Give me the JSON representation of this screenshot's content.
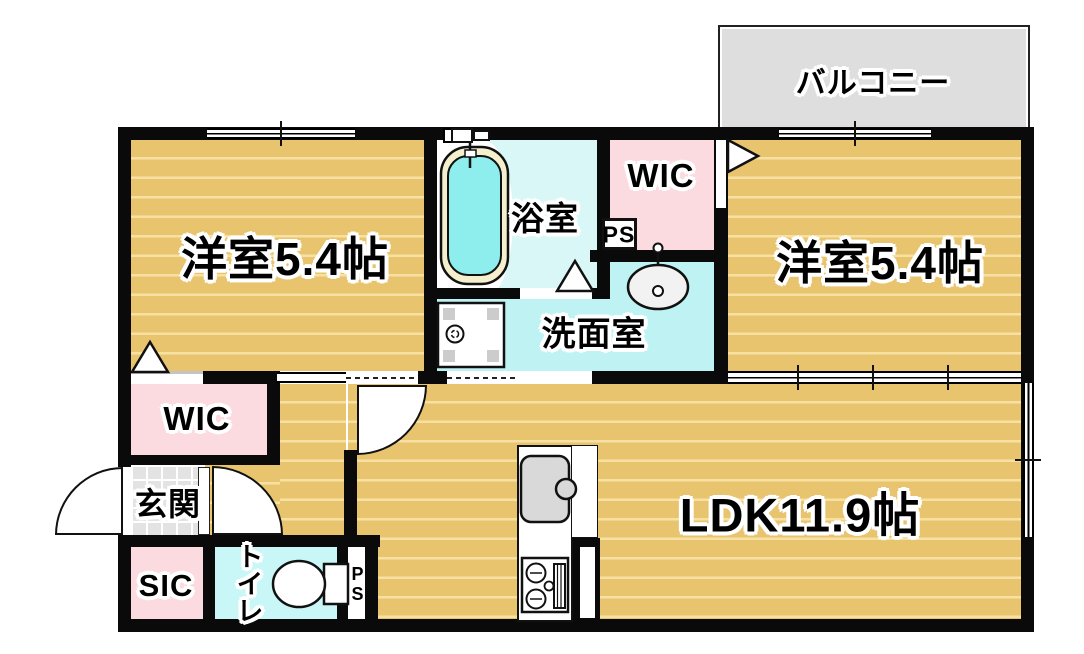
{
  "title": "apartment-floorplan",
  "rooms": {
    "bedroom_left": {
      "label": "洋室5.4帖"
    },
    "bedroom_right": {
      "label": "洋室5.4帖"
    },
    "ldk": {
      "label": "LDK11.9帖"
    },
    "balcony": {
      "label": "バルコニー"
    },
    "bathroom": {
      "label": "浴室"
    },
    "washroom": {
      "label": "洗面室"
    },
    "wic_right": {
      "label": "WIC"
    },
    "wic_left": {
      "label": "WIC"
    },
    "ps_top": {
      "label": "PS"
    },
    "ps_bottom": {
      "label": "PS"
    },
    "genkan": {
      "label": "玄関"
    },
    "sic": {
      "label": "SIC"
    },
    "toilet": {
      "label": "トイレ"
    }
  },
  "fixtures": [
    "bathtub-icon",
    "bath-faucet-icon",
    "washbasin-icon",
    "washing-machine-pan-icon",
    "kitchen-sink-icon",
    "gas-stove-icon",
    "toilet-icon",
    "door-swing-arc",
    "door-triangle-marker",
    "window-glyph"
  ],
  "colors": {
    "floor_tan": "#e9c46f",
    "floor_stripe": "#f6e0a2",
    "bath_cyan": "#d9f7f7",
    "wash_cyan": "#bff2f3",
    "toilet_cyan": "#c9f6f7",
    "pink": "#fbdbdf",
    "balcony_gray": "#dedede",
    "tile_gray": "#e3e3e3",
    "wall": "#0a0a0a",
    "tub_cream": "#f4efcd",
    "water": "#8eeeee",
    "fixture_gray": "#d9d9d9"
  }
}
